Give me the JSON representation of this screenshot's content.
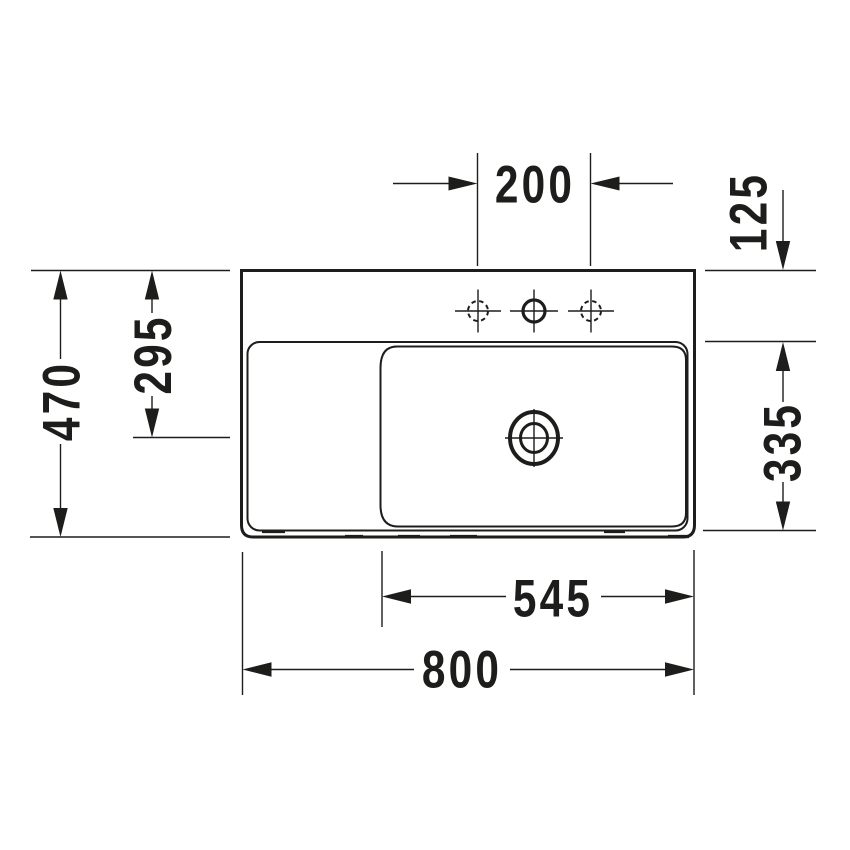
{
  "page": {
    "background": "#ffffff",
    "line_color": "#1d1d1b"
  },
  "drawing": {
    "dims": {
      "top_center": "200",
      "top_right": "125",
      "left_outer": "470",
      "left_inner": "295",
      "right_lower": "335",
      "bottom_inner": "545",
      "bottom_outer": "800"
    }
  }
}
